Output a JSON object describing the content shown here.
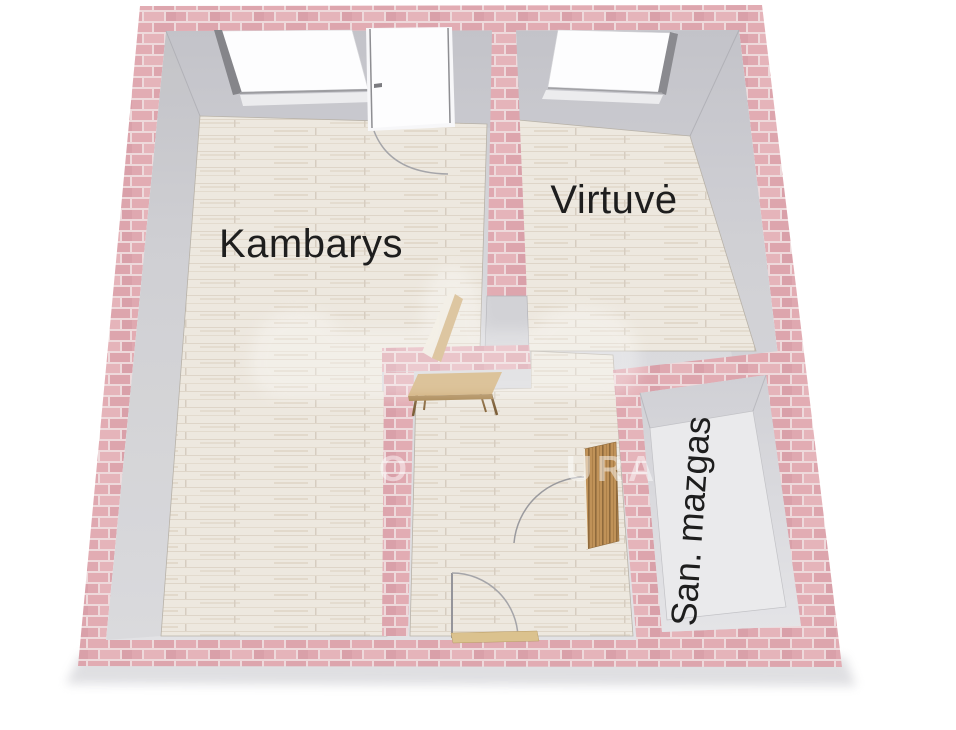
{
  "floorplan": {
    "title": "apartment-floorplan-3d",
    "rooms": {
      "kambarys": {
        "label": "Kambarys"
      },
      "virtuve": {
        "label": "Virtuvė"
      },
      "san_mazgas": {
        "label": "San. mazgas"
      }
    },
    "watermark": {
      "fragment_left": "O",
      "fragment_right": "URA"
    },
    "colors": {
      "brick": "#dfa9b0",
      "mortar": "#eed9db",
      "wall_gray": "#d4d4d8",
      "floor_wood": "#ede8df",
      "floor_bath": "#eaeaec",
      "label_text": "#1e1e1e",
      "door_wood": "#c09258",
      "threshold": "#dbc28e",
      "window_glass": "#fdfdfe"
    }
  }
}
